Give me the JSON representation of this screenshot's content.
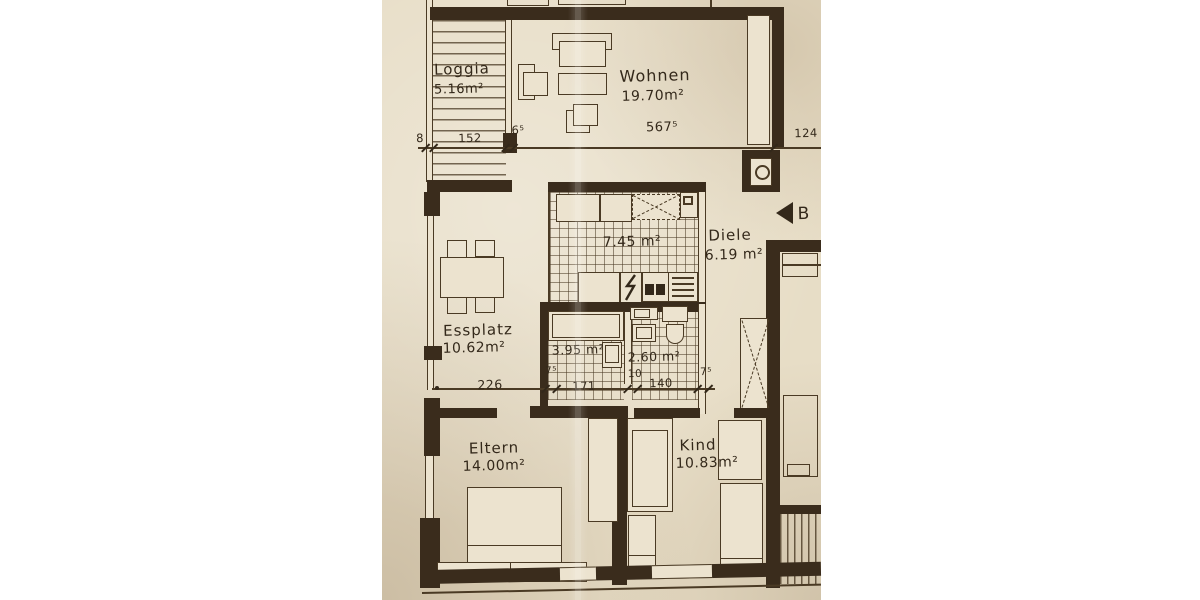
{
  "colors": {
    "paper": "#e7ddc6",
    "ink": "#33281a",
    "wall": "#3a2c1c"
  },
  "rooms": {
    "loggia": {
      "name": "Loggia",
      "area": "5.16m²"
    },
    "wohnen": {
      "name": "Wohnen",
      "area": "19.70m²"
    },
    "kueche": {
      "area": "7.45 m²"
    },
    "diele": {
      "name": "Diele",
      "area": "6.19 m²"
    },
    "essplatz": {
      "name": "Essplatz",
      "area": "10.62m²"
    },
    "bad": {
      "area": "3.95 m²"
    },
    "wc": {
      "area": "2.60 m²"
    },
    "eltern": {
      "name": "Eltern",
      "area": "14.00m²"
    },
    "kind": {
      "name": "Kind",
      "area": "10.83m²"
    }
  },
  "dims": {
    "d8": "8",
    "d152": "152",
    "d65": "6⁵",
    "d5675": "567⁵",
    "d124": "124",
    "d226": "226",
    "d75a": "7⁵",
    "d171": "171",
    "d10": "10",
    "d140": "140",
    "d75b": "7⁵"
  },
  "marker": {
    "label": "B"
  }
}
